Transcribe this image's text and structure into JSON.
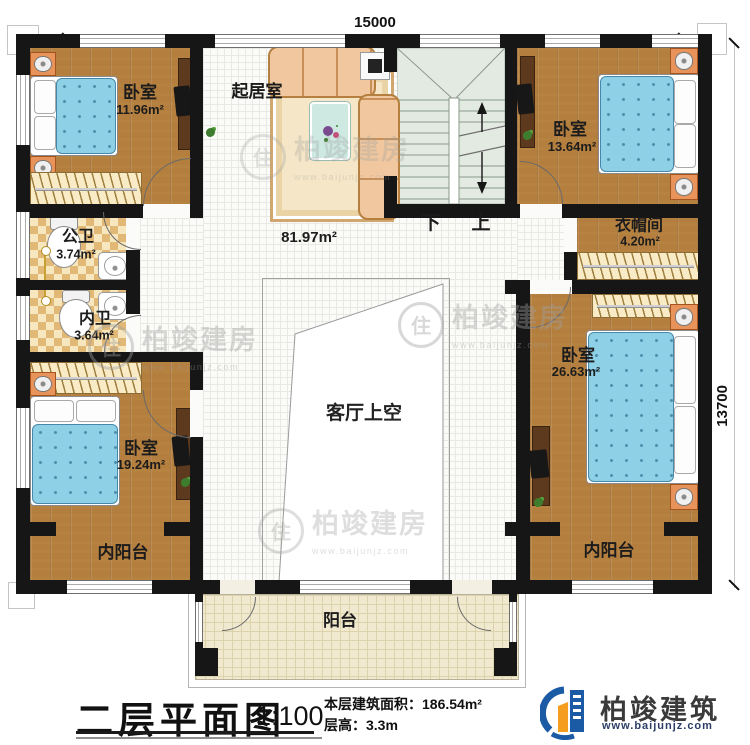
{
  "dimensions": {
    "width_mm": "15000",
    "height_mm": "13700"
  },
  "rooms": {
    "bedroom_tl": {
      "name": "卧室",
      "area": "11.96m²"
    },
    "living": {
      "name": "起居室"
    },
    "bedroom_tr": {
      "name": "卧室",
      "area": "13.64m²"
    },
    "hall_area": "81.97m²",
    "public_bath": {
      "name": "公卫",
      "area": "3.74m²"
    },
    "private_bath": {
      "name": "内卫",
      "area": "3.64m²"
    },
    "cloakroom": {
      "name": "衣帽间",
      "area": "4.20m²"
    },
    "bedroom_bl": {
      "name": "卧室",
      "area": "19.24m²"
    },
    "bedroom_br": {
      "name": "卧室",
      "area": "26.63m²"
    },
    "inner_balcony_left": {
      "name": "内阳台"
    },
    "inner_balcony_right": {
      "name": "内阳台"
    },
    "void": {
      "name": "客厅上空"
    },
    "balcony": {
      "name": "阳台"
    }
  },
  "stairs": {
    "down": "下",
    "up": "上"
  },
  "titleblock": {
    "title": "二层平面图",
    "scale": "1:100",
    "area_label": "本层建筑面积：",
    "area_value": "186.54m²",
    "height_label": "层高：",
    "height_value": "3.3m"
  },
  "brand": {
    "name": "柏竣建筑",
    "url": "www.baijunjz.com"
  },
  "watermark": {
    "glyph": "住",
    "name": "柏竣建房",
    "url": "www.baijunjz.com"
  },
  "colors": {
    "wall": "#161616",
    "wood": "#b37e3e",
    "bed_blue": "#8ed1e6",
    "logo_blue": "#1b5aa5",
    "logo_orange": "#f59d1f"
  }
}
